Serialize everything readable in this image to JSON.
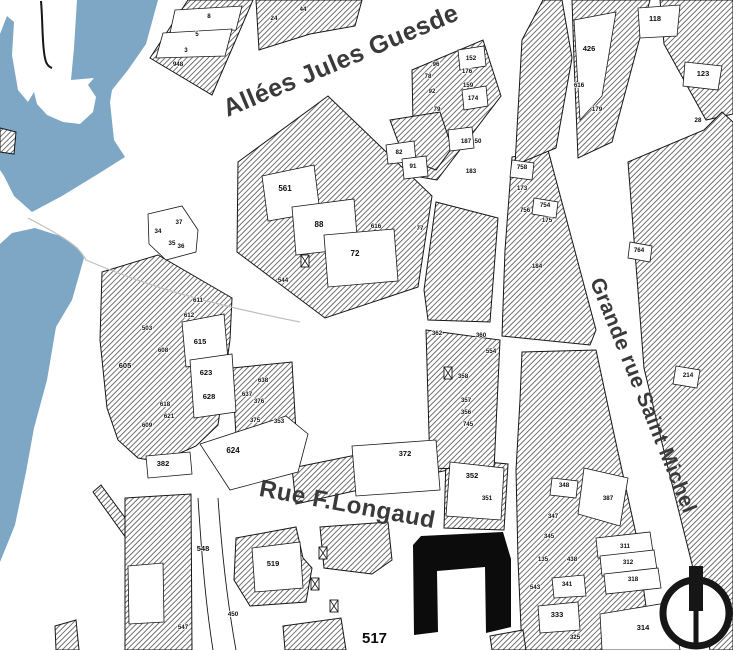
{
  "title": "Cadastral city map",
  "colors": {
    "river": "#7DA7C4",
    "ink": "#161616",
    "hatch_line": "#1c1c1c",
    "label": "#3a3a3a",
    "halo": "#ffffff",
    "building": "#0c0c0c",
    "faint": "#bfbfbf",
    "background": "#ffffff"
  },
  "streets": [
    {
      "id": "allees",
      "name": "Allées Jules Guesde",
      "x": 344,
      "y": 68,
      "rotate": -22.8,
      "size": 25
    },
    {
      "id": "grande",
      "name": "Grande rue Saint Michel",
      "x": 637,
      "y": 398,
      "rotate": 68,
      "size": 21
    },
    {
      "id": "longaud",
      "name": "Rue F.Longaud",
      "x": 346,
      "y": 512,
      "rotate": 10.5,
      "size": 24
    }
  ],
  "special_label": {
    "text": "517",
    "x": 362,
    "y": 643,
    "size": 15
  },
  "compass": {
    "cx": 696,
    "cy": 613,
    "r": 33,
    "ring_width": 7
  },
  "parcels": [
    {
      "n": "8",
      "x": 209,
      "y": 18
    },
    {
      "n": "5",
      "x": 197,
      "y": 36
    },
    {
      "n": "3",
      "x": 186,
      "y": 52
    },
    {
      "n": "948",
      "x": 178,
      "y": 66
    },
    {
      "n": "24",
      "x": 274,
      "y": 20
    },
    {
      "n": "44",
      "x": 303,
      "y": 11
    },
    {
      "n": "118",
      "x": 655,
      "y": 21,
      "s": 7.5
    },
    {
      "n": "426",
      "x": 589,
      "y": 51,
      "s": 7.5
    },
    {
      "n": "123",
      "x": 703,
      "y": 76,
      "s": 7.5
    },
    {
      "n": "616",
      "x": 579,
      "y": 87
    },
    {
      "n": "179",
      "x": 597,
      "y": 111
    },
    {
      "n": "28",
      "x": 698,
      "y": 122
    },
    {
      "n": "96",
      "x": 436,
      "y": 66
    },
    {
      "n": "152",
      "x": 471,
      "y": 60
    },
    {
      "n": "78",
      "x": 428,
      "y": 78
    },
    {
      "n": "176",
      "x": 467,
      "y": 73
    },
    {
      "n": "92",
      "x": 432,
      "y": 93
    },
    {
      "n": "159",
      "x": 468,
      "y": 87
    },
    {
      "n": "174",
      "x": 473,
      "y": 100
    },
    {
      "n": "79",
      "x": 437,
      "y": 111
    },
    {
      "n": "187",
      "x": 466,
      "y": 143
    },
    {
      "n": "50",
      "x": 478,
      "y": 143
    },
    {
      "n": "183",
      "x": 471,
      "y": 173
    },
    {
      "n": "82",
      "x": 399,
      "y": 154
    },
    {
      "n": "91",
      "x": 413,
      "y": 168
    },
    {
      "n": "561",
      "x": 285,
      "y": 191,
      "s": 8
    },
    {
      "n": "88",
      "x": 319,
      "y": 227,
      "s": 8
    },
    {
      "n": "72",
      "x": 355,
      "y": 256,
      "s": 8
    },
    {
      "n": "544",
      "x": 283,
      "y": 282
    },
    {
      "n": "37",
      "x": 179,
      "y": 224
    },
    {
      "n": "34",
      "x": 158,
      "y": 233
    },
    {
      "n": "35",
      "x": 172,
      "y": 245
    },
    {
      "n": "36",
      "x": 181,
      "y": 248
    },
    {
      "n": "616",
      "x": 376,
      "y": 228
    },
    {
      "n": "77",
      "x": 420,
      "y": 230
    },
    {
      "n": "503",
      "x": 147,
      "y": 330
    },
    {
      "n": "611",
      "x": 198,
      "y": 302
    },
    {
      "n": "612",
      "x": 189,
      "y": 317
    },
    {
      "n": "615",
      "x": 200,
      "y": 344,
      "s": 7.5
    },
    {
      "n": "608",
      "x": 163,
      "y": 352
    },
    {
      "n": "605",
      "x": 125,
      "y": 368,
      "s": 7.5
    },
    {
      "n": "623",
      "x": 206,
      "y": 375,
      "s": 7.5
    },
    {
      "n": "628",
      "x": 209,
      "y": 399,
      "s": 7.5
    },
    {
      "n": "638",
      "x": 263,
      "y": 382
    },
    {
      "n": "637",
      "x": 247,
      "y": 396
    },
    {
      "n": "376",
      "x": 259,
      "y": 403
    },
    {
      "n": "375",
      "x": 255,
      "y": 422
    },
    {
      "n": "353",
      "x": 279,
      "y": 423
    },
    {
      "n": "618",
      "x": 165,
      "y": 406
    },
    {
      "n": "621",
      "x": 169,
      "y": 418
    },
    {
      "n": "609",
      "x": 147,
      "y": 427
    },
    {
      "n": "624",
      "x": 233,
      "y": 453,
      "s": 8
    },
    {
      "n": "382",
      "x": 163,
      "y": 466,
      "s": 7.5
    },
    {
      "n": "548",
      "x": 203,
      "y": 551,
      "s": 7.5
    },
    {
      "n": "519",
      "x": 273,
      "y": 566,
      "s": 7.5
    },
    {
      "n": "450",
      "x": 233,
      "y": 616
    },
    {
      "n": "547",
      "x": 183,
      "y": 629
    },
    {
      "n": "362",
      "x": 437,
      "y": 335
    },
    {
      "n": "360",
      "x": 481,
      "y": 337
    },
    {
      "n": "554",
      "x": 491,
      "y": 353
    },
    {
      "n": "358",
      "x": 463,
      "y": 378
    },
    {
      "n": "357",
      "x": 466,
      "y": 402
    },
    {
      "n": "356",
      "x": 466,
      "y": 414
    },
    {
      "n": "745",
      "x": 468,
      "y": 426
    },
    {
      "n": "372",
      "x": 405,
      "y": 456,
      "s": 7.5
    },
    {
      "n": "352",
      "x": 472,
      "y": 478,
      "s": 7.5
    },
    {
      "n": "351",
      "x": 487,
      "y": 500
    },
    {
      "n": "758",
      "x": 522,
      "y": 169
    },
    {
      "n": "173",
      "x": 522,
      "y": 190
    },
    {
      "n": "754",
      "x": 545,
      "y": 207
    },
    {
      "n": "756",
      "x": 525,
      "y": 212
    },
    {
      "n": "175",
      "x": 547,
      "y": 222
    },
    {
      "n": "184",
      "x": 537,
      "y": 268
    },
    {
      "n": "764",
      "x": 639,
      "y": 252
    },
    {
      "n": "214",
      "x": 688,
      "y": 377
    },
    {
      "n": "348",
      "x": 564,
      "y": 487
    },
    {
      "n": "387",
      "x": 608,
      "y": 500
    },
    {
      "n": "347",
      "x": 553,
      "y": 518
    },
    {
      "n": "345",
      "x": 549,
      "y": 538
    },
    {
      "n": "311",
      "x": 625,
      "y": 548
    },
    {
      "n": "312",
      "x": 628,
      "y": 564
    },
    {
      "n": "318",
      "x": 633,
      "y": 581
    },
    {
      "n": "135",
      "x": 543,
      "y": 561
    },
    {
      "n": "438",
      "x": 572,
      "y": 561
    },
    {
      "n": "341",
      "x": 567,
      "y": 586
    },
    {
      "n": "543",
      "x": 535,
      "y": 589
    },
    {
      "n": "333",
      "x": 557,
      "y": 617,
      "s": 7.5
    },
    {
      "n": "325",
      "x": 575,
      "y": 639
    },
    {
      "n": "314",
      "x": 643,
      "y": 630,
      "s": 7.5
    }
  ],
  "geometry": {
    "river": [
      "M0,34 L7,16 L14,22 L12,55 L18,90 L28,102 L34,92 L37,104 L47,115 L63,122 L80,124 L93,112 L96,97 L88,85 L94,78 L71,80 L74,48 L77,0 L158,0 L146,44 L128,70 L112,90 L110,102 L114,140 L125,157 L98,174 L62,196 L32,212 L14,196 L4,176 L0,170 Z",
      "M0,244 L12,233 L35,228 L60,236 L78,248 L84,258 L72,300 L56,327 L47,380 L34,428 L26,472 L15,525 L0,562 Z"
    ],
    "blocks": [
      "M150,58 L188,0 L253,0 L212,95 Z",
      "M256,0 L362,0 L355,26 L310,34 L259,50 Z",
      "M238,162 L328,96 L432,196 L418,287 L325,318 L237,252 Z",
      "M412,70 L483,40 L501,96 L437,180 L414,176 Z",
      "M390,120 L440,112 L452,148 L436,170 L404,158 Z",
      "M102,272 L158,255 L232,298 L230,340 L218,425 L196,446 L160,462 L138,458 L118,440 L107,408 L100,340 Z",
      "M93,492 L101,485 L134,530 L126,538 Z",
      "M125,498 L191,494 L192,650 L125,650 Z",
      "M55,626 L76,620 L79,650 L56,650 Z",
      "M236,538 L296,527 L303,558 L312,568 L306,602 L250,606 L234,580 Z",
      "M292,468 L420,442 L450,448 L448,470 L296,504 Z",
      "M446,458 L508,464 L504,530 L444,528 Z",
      "M426,330 L500,340 L494,470 L430,468 Z",
      "M436,202 L498,218 L490,322 L428,320 L424,290 Z",
      "M512,157 L548,150 L572,240 L596,330 L590,345 L502,336 L505,250 Z",
      "M522,40 L543,0 L562,0 L572,58 L556,148 L515,165 Z",
      "M572,0 L650,0 L612,142 L578,158 L574,60 Z",
      "M660,0 L733,0 L733,114 L706,120 L664,44 Z",
      "M628,162 L704,130 L722,112 L733,122 L733,650 L710,650 L694,572 L668,468 L644,368 Z",
      "M522,352 L596,350 L614,434 L636,534 L652,650 L522,650 L518,560 L516,470 L520,400 Z",
      "M232,368 L292,362 L296,432 L236,436 Z",
      "M283,626 L341,618 L346,650 L285,650 Z",
      "M490,636 L523,630 L526,650 L492,650 Z",
      "M0,128 L16,132 L14,154 L0,152 Z",
      "M320,527 L388,522 L392,560 L372,574 L324,568 Z"
    ],
    "lots": [
      "M175,10 L242,6 L236,30 L170,33 Z",
      "M163,33 L232,29 L225,56 L156,58 Z",
      "M262,176 L314,165 L320,212 L268,221 Z",
      "M292,207 L354,199 L358,248 L296,255 Z",
      "M324,235 L394,229 L398,281 L328,287 Z",
      "M386,145 L414,141 L416,161 L388,164 Z",
      "M402,159 L426,156 L428,176 L404,179 Z",
      "M574,20 L616,12 L602,96 L580,120 Z",
      "M638,8 L680,5 L677,36 L640,38 Z",
      "M685,62 L722,66 L718,90 L683,86 Z",
      "M182,322 L224,314 L228,360 L186,367 Z",
      "M190,360 L232,354 L236,412 L194,418 Z",
      "M148,214 L182,206 L198,230 L196,252 L166,260 L149,244 Z",
      "M200,444 L286,416 L308,434 L298,472 L230,490 Z",
      "M146,456 L190,452 L192,474 L148,478 Z",
      "M252,548 L300,542 L303,588 L255,592 Z",
      "M352,446 L436,440 L440,490 L356,496 Z",
      "M450,462 L504,468 L501,520 L446,516 Z",
      "M128,566 L163,563 L164,622 L129,624 Z",
      "M584,468 L628,478 L620,526 L578,514 Z",
      "M596,538 L650,532 L653,552 L598,558 Z",
      "M600,556 L654,550 L657,570 L602,576 Z",
      "M604,574 L658,568 L661,588 L606,594 Z",
      "M600,614 L672,602 L680,650 L602,650 Z",
      "M538,606 L578,602 L580,630 L540,633 Z",
      "M552,578 L584,575 L586,596 L554,598 Z",
      "M630,242 L652,246 L650,262 L628,258 Z",
      "M676,366 L700,370 L697,388 L673,384 Z",
      "M458,50 L484,46 L486,66 L460,70 Z",
      "M462,90 L486,86 L488,106 L464,110 Z",
      "M448,130 L472,127 L474,148 L450,151 Z",
      "M534,198 L558,202 L556,218 L532,214 Z",
      "M512,160 L534,163 L532,180 L510,177 Z",
      "M552,478 L578,481 L576,498 L550,495 Z"
    ],
    "building": "M413,545 L421,536 L503,532 L511,559 L511,627 L486,633 L485,567 L437,571 L438,632 L414,635 Z",
    "lines": [
      {
        "d": "M41,1 C43,25 42,45 45,58 C46,64 49,67 52,68",
        "w": 2,
        "c": "ink"
      },
      {
        "d": "M28,218 C70,240 80,248 86,260 C160,292 230,308 300,322",
        "w": 1.2,
        "c": "faint"
      },
      {
        "d": "M198,498 C202,560 206,606 213,650",
        "w": 0.9,
        "c": "ink"
      },
      {
        "d": "M218,498 C222,556 228,606 236,650",
        "w": 0.9,
        "c": "ink"
      }
    ],
    "xboxes": [
      [
        305,
        261
      ],
      [
        448,
        373
      ],
      [
        323,
        553
      ],
      [
        315,
        584
      ],
      [
        334,
        606
      ]
    ]
  }
}
